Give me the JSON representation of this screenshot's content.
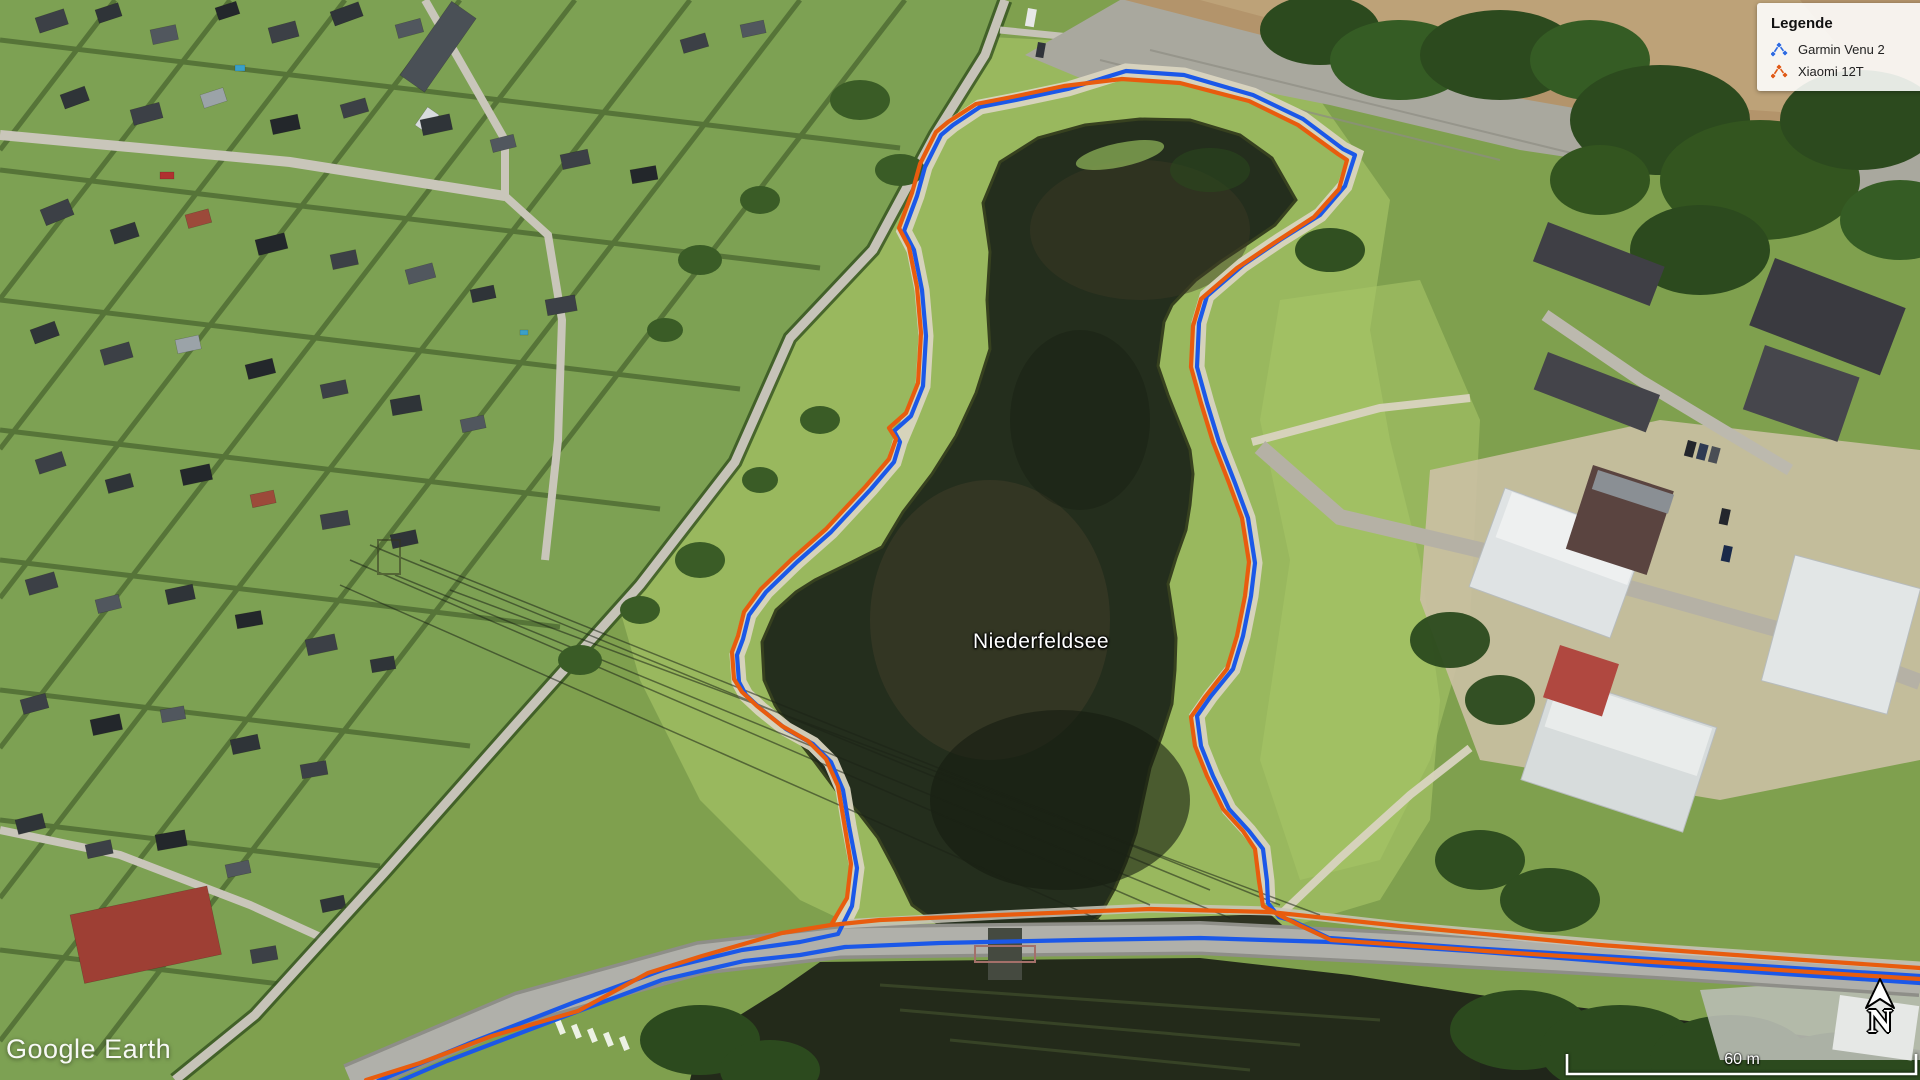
{
  "app": {
    "watermark": "Google Earth"
  },
  "map": {
    "place_label": "Niederfeldsee",
    "scale_bar_label": "60 m",
    "north_label": "N"
  },
  "legend": {
    "title": "Legende",
    "items": [
      {
        "id": "garmin-venu-2",
        "label": "Garmin Venu 2",
        "color": "#2e6ae0"
      },
      {
        "id": "xiaomi-12t",
        "label": "Xiaomi 12T",
        "color": "#df5a17"
      }
    ]
  },
  "tracks": [
    {
      "id": "garmin-venu-2",
      "name": "Garmin Venu 2",
      "color": "#1b58e8",
      "width": 4.2,
      "polylines": [
        [
          [
            378,
            1081
          ],
          [
            470,
            1043
          ],
          [
            575,
            1002
          ],
          [
            668,
            968
          ],
          [
            742,
            950
          ],
          [
            800,
            942
          ],
          [
            838,
            934
          ],
          [
            852,
            906
          ],
          [
            857,
            868
          ],
          [
            849,
            826
          ],
          [
            843,
            790
          ],
          [
            831,
            762
          ],
          [
            813,
            744
          ],
          [
            786,
            729
          ],
          [
            761,
            709
          ],
          [
            746,
            695
          ],
          [
            739,
            682
          ],
          [
            737,
            655
          ],
          [
            743,
            639
          ],
          [
            749,
            615
          ],
          [
            766,
            592
          ],
          [
            797,
            562
          ],
          [
            831,
            532
          ],
          [
            871,
            489
          ],
          [
            894,
            462
          ],
          [
            900,
            442
          ],
          [
            894,
            431
          ],
          [
            911,
            416
          ],
          [
            923,
            386
          ],
          [
            926,
            336
          ],
          [
            922,
            290
          ],
          [
            914,
            250
          ],
          [
            904,
            231
          ],
          [
            917,
            196
          ],
          [
            925,
            167
          ],
          [
            941,
            135
          ],
          [
            953,
            125
          ],
          [
            980,
            107
          ],
          [
            1016,
            100
          ],
          [
            1068,
            89
          ],
          [
            1126,
            71
          ],
          [
            1184,
            75
          ],
          [
            1253,
            95
          ],
          [
            1303,
            119
          ],
          [
            1343,
            149
          ],
          [
            1355,
            155
          ],
          [
            1345,
            186
          ],
          [
            1320,
            215
          ],
          [
            1280,
            240
          ],
          [
            1243,
            265
          ],
          [
            1207,
            296
          ],
          [
            1199,
            323
          ],
          [
            1197,
            367
          ],
          [
            1207,
            403
          ],
          [
            1219,
            442
          ],
          [
            1235,
            483
          ],
          [
            1248,
            518
          ],
          [
            1255,
            563
          ],
          [
            1251,
            596
          ],
          [
            1243,
            636
          ],
          [
            1233,
            669
          ],
          [
            1211,
            696
          ],
          [
            1197,
            716
          ],
          [
            1201,
            746
          ],
          [
            1213,
            776
          ],
          [
            1229,
            809
          ],
          [
            1249,
            831
          ],
          [
            1263,
            849
          ],
          [
            1267,
            881
          ],
          [
            1268,
            903
          ],
          [
            1279,
            917
          ],
          [
            1293,
            921
          ],
          [
            1329,
            938
          ],
          [
            1470,
            948
          ],
          [
            1650,
            959
          ],
          [
            1920,
            976
          ]
        ],
        [
          [
            400,
            1081
          ],
          [
            447,
            1061
          ],
          [
            560,
            1018
          ],
          [
            662,
            980
          ],
          [
            744,
            961
          ],
          [
            800,
            955
          ],
          [
            845,
            947
          ],
          [
            940,
            943
          ],
          [
            1080,
            940
          ],
          [
            1200,
            938
          ],
          [
            1330,
            942
          ],
          [
            1470,
            951
          ],
          [
            1650,
            965
          ],
          [
            1920,
            983
          ]
        ]
      ]
    },
    {
      "id": "xiaomi-12t",
      "name": "Xiaomi 12T",
      "color": "#e85c0e",
      "width": 4.2,
      "polylines": [
        [
          [
            366,
            1080
          ],
          [
            420,
            1063
          ],
          [
            492,
            1036
          ],
          [
            578,
            1011
          ],
          [
            648,
            973
          ],
          [
            702,
            956
          ],
          [
            782,
            933
          ],
          [
            831,
            925
          ],
          [
            847,
            898
          ],
          [
            851,
            864
          ],
          [
            844,
            822
          ],
          [
            838,
            786
          ],
          [
            826,
            759
          ],
          [
            808,
            741
          ],
          [
            782,
            726
          ],
          [
            757,
            706
          ],
          [
            742,
            692
          ],
          [
            734,
            679
          ],
          [
            732,
            652
          ],
          [
            738,
            636
          ],
          [
            744,
            612
          ],
          [
            761,
            589
          ],
          [
            792,
            559
          ],
          [
            826,
            529
          ],
          [
            866,
            486
          ],
          [
            889,
            459
          ],
          [
            896,
            439
          ],
          [
            889,
            428
          ],
          [
            906,
            413
          ],
          [
            918,
            383
          ],
          [
            921,
            333
          ],
          [
            917,
            287
          ],
          [
            909,
            247
          ],
          [
            899,
            228
          ],
          [
            912,
            193
          ],
          [
            920,
            164
          ],
          [
            936,
            132
          ],
          [
            948,
            122
          ],
          [
            976,
            104
          ],
          [
            1012,
            97
          ],
          [
            1064,
            86
          ],
          [
            1122,
            79
          ],
          [
            1180,
            83
          ],
          [
            1249,
            101
          ],
          [
            1298,
            125
          ],
          [
            1338,
            154
          ],
          [
            1347,
            160
          ],
          [
            1339,
            189
          ],
          [
            1314,
            217
          ],
          [
            1274,
            243
          ],
          [
            1237,
            268
          ],
          [
            1201,
            299
          ],
          [
            1193,
            326
          ],
          [
            1191,
            367
          ],
          [
            1201,
            403
          ],
          [
            1213,
            442
          ],
          [
            1229,
            483
          ],
          [
            1242,
            518
          ],
          [
            1249,
            562
          ],
          [
            1245,
            596
          ],
          [
            1237,
            636
          ],
          [
            1227,
            669
          ],
          [
            1205,
            697
          ],
          [
            1191,
            717
          ],
          [
            1195,
            746
          ],
          [
            1207,
            776
          ],
          [
            1223,
            809
          ],
          [
            1243,
            831
          ],
          [
            1255,
            849
          ],
          [
            1259,
            881
          ],
          [
            1263,
            906
          ],
          [
            1281,
            916
          ],
          [
            1301,
            926
          ],
          [
            1331,
            940
          ],
          [
            1500,
            952
          ],
          [
            1700,
            965
          ],
          [
            1920,
            979
          ]
        ],
        [
          [
            831,
            925
          ],
          [
            880,
            920
          ],
          [
            1000,
            915
          ],
          [
            1150,
            909
          ],
          [
            1270,
            912
          ],
          [
            1400,
            926
          ],
          [
            1600,
            945
          ],
          [
            1790,
            959
          ],
          [
            1920,
            968
          ]
        ]
      ]
    }
  ]
}
